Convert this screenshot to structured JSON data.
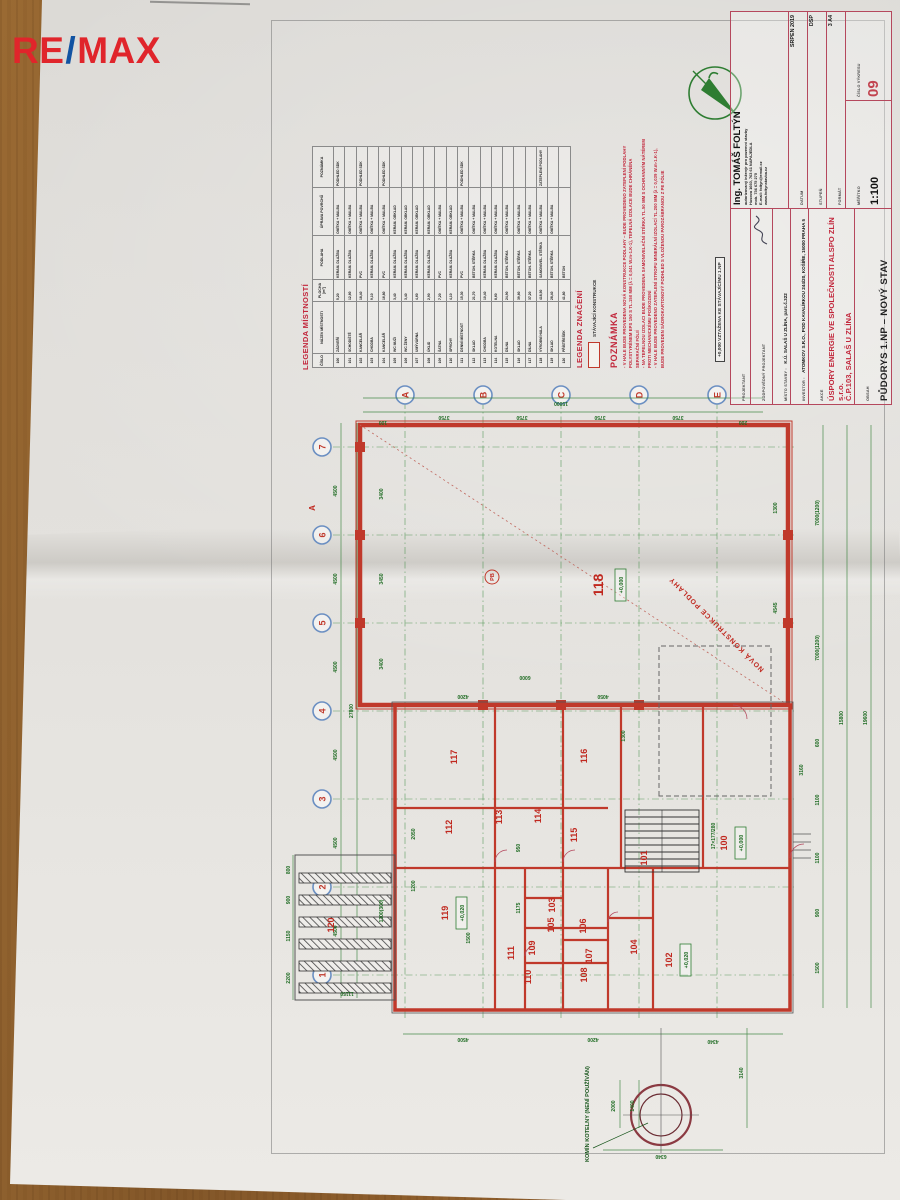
{
  "watermark": {
    "text": "RE/MAX",
    "re": "RE",
    "slash": "/",
    "max": "MAX",
    "red": "#e0252b",
    "blue": "#1253a2"
  },
  "legend": {
    "title": "LEGENDA MÍSTNOSTÍ",
    "headers": [
      "ČÍSLO",
      "NÁZEV MÍSTNOSTI",
      "PLOCHA [m²]",
      "PODLAHA",
      "ÚPRAVA POVRCHŮ",
      "POZNÁMKA"
    ],
    "rows": [
      [
        "100",
        "ZÁDVEŘÍ",
        "5,20",
        "KERAM. DLAŽBA",
        "OMÍTKA + MALBA",
        "PODHLED SDK"
      ],
      [
        "101",
        "SCHODIŠTĚ",
        "12,60",
        "KERAM. DLAŽBA",
        "OMÍTKA + MALBA",
        ""
      ],
      [
        "102",
        "KANCELÁŘ",
        "18,40",
        "PVC",
        "OMÍTKA + MALBA",
        "PODHLED SDK"
      ],
      [
        "103",
        "CHODBA",
        "9,10",
        "KERAM. DLAŽBA",
        "OMÍTKA + MALBA",
        ""
      ],
      [
        "104",
        "KANCELÁŘ",
        "16,80",
        "PVC",
        "OMÍTKA + MALBA",
        "PODHLED SDK"
      ],
      [
        "105",
        "WC MUŽI",
        "3,40",
        "KERAM. DLAŽBA",
        "KERAM. OBKLAD",
        ""
      ],
      [
        "106",
        "WC ŽENY",
        "3,40",
        "KERAM. DLAŽBA",
        "KERAM. OBKLAD",
        ""
      ],
      [
        "107",
        "UMÝVÁRNA",
        "4,60",
        "KERAM. DLAŽBA",
        "KERAM. OBKLAD",
        ""
      ],
      [
        "108",
        "ÚKLID",
        "2,90",
        "KERAM. DLAŽBA",
        "KERAM. OBKLAD",
        ""
      ],
      [
        "109",
        "ŠATNA",
        "7,20",
        "PVC",
        "OMÍTKA + MALBA",
        ""
      ],
      [
        "110",
        "SPRCHY",
        "4,10",
        "KERAM. DLAŽBA",
        "KERAM. OBKLAD",
        ""
      ],
      [
        "111",
        "DENNÍ MÍSTNOST",
        "15,30",
        "PVC",
        "OMÍTKA + MALBA",
        "PODHLED SDK"
      ],
      [
        "112",
        "SKLAD",
        "21,70",
        "BETON. STĚRKA",
        "OMÍTKA + MALBA",
        ""
      ],
      [
        "113",
        "CHODBA",
        "10,40",
        "KERAM. DLAŽBA",
        "OMÍTKA + MALBA",
        ""
      ],
      [
        "114",
        "KOTELNA",
        "8,60",
        "KERAM. DLAŽBA",
        "OMÍTKA + MALBA",
        ""
      ],
      [
        "115",
        "DÍLNA",
        "24,90",
        "BETON. STĚRKA",
        "OMÍTKA + MALBA",
        ""
      ],
      [
        "116",
        "SKLAD",
        "39,60",
        "BETON. STĚRKA",
        "OMÍTKA + MALBA",
        ""
      ],
      [
        "117",
        "DÍLNA",
        "37,20",
        "BETON. STĚRKA",
        "OMÍTKA + MALBA",
        ""
      ],
      [
        "118",
        "VÝROBNÍ HALA",
        "418,50",
        "SAMONIVEL. STĚRKA",
        "OMÍTKA + MALBA",
        "ZATEPLENÍ PODLAHY"
      ],
      [
        "119",
        "SKLAD",
        "28,40",
        "BETON. STĚRKA",
        "OMÍTKA + MALBA",
        ""
      ],
      [
        "120",
        "PŘÍSTŘEŠEK",
        "41,80",
        "BETON",
        "",
        ""
      ]
    ]
  },
  "marks": {
    "title": "LEGENDA ZNAČENÍ",
    "items": [
      {
        "label": "STÁVAJÍCÍ KONSTRUKCE"
      }
    ]
  },
  "note": {
    "title": "POZNÁMKA",
    "lines": [
      "V HALE BUDE PROVEDENA NOVÁ KONSTRUKCE PODLAHY – BUDE PROVEDENO ZATEPLENÍ PODLAHY POLYSTYRÉNEM EPS 150 S TL.150 MM (λ = 0,041 W.m-1.K-1), TEPELNÁ IZOLACE BUDE CHRÁNĚNA SEPARAČNÍ FÓLIÍ",
      "NA TEPELNOU IZOLACI BUDE PROVEDENA SAMONIVELAČNÍ STĚRKA TL.50 MM S OCHRANNÝM NÁTĚREM PROTI MECHANICKÉMU POŠKOZENÍ",
      "V HALE BUDE PROVEDENO ZATEPLENÍ STROPU MINERÁLNÍ IZOLACÍ TL.200 MM (λ = 0,039 W.m-1.K-1), BUDE PROVEDEN SÁDROKARTONOVÝ PODHLED S VLOŽENOU PAROZÁBRANOU Z PE FÓLIE"
    ]
  },
  "datum_note": "+0,000 VZTAŽENA KE STÁVAJÍCÍMU 1.NP",
  "title_block": {
    "projektant_label": "PROJEKTANT",
    "projektant": "MICHAELA VELCEROVÁ",
    "zodp_label": "ZODPOVĚDNÝ PROJEKTANT",
    "zodp": "ING. TOMÁŠ FOLTÝN",
    "misto_label": "MÍSTO STAVBY :",
    "misto": "K.Ú. SALAŠ U ZLÍNA, parc.č.322",
    "investor_label": "INVESTOR :",
    "investor": "ATOMKOV S.R.O., POD KAVALÍRKOU 244/20, KOŠÍŘE, 15000 PRAHA 5",
    "akce_label": "AKCE",
    "akce1": "ÚSPORY ENERGIE VE SPOLEČNOSTI ALSPO ZLÍN s.r.o.",
    "akce2": "Č.P.103, SALAŠ U ZLÍNA",
    "akce3": "D.1.1 ARCHITEKTONICKO-STAVEBNÍ ŘEŠENÍ",
    "obsah_label": "OBSAH",
    "obsah": "PŮDORYS 1.NP – NOVÝ STAV",
    "eng_name": "Ing. TOMÁŠ FOLTÝN",
    "eng_sub1": "autorizovaný inženýr pro pozemní stavby",
    "eng_sub2": "Husova 1660, 763 61 NAPAJEDLA",
    "eng_sub3": "mob. 736 675 275",
    "eng_sub4": "E-mail: foltyn@email.cz",
    "eng_sub5": "www.foltynstavba.cz",
    "datum_label": "DATUM",
    "datum": "SRPEN 2019",
    "stupen_label": "STUPEŇ",
    "stupen": "DSP",
    "format_label": "FORMÁT",
    "format": "3 A4",
    "meritko_label": "MĚŘÍTKO",
    "meritko": "1:100",
    "cislo_label": "ČÍSLO VÝKRESU",
    "cislo": "09"
  },
  "plan": {
    "grid_cols": [
      {
        "n": "1",
        "x": 193
      },
      {
        "n": "2",
        "x": 281
      },
      {
        "n": "3",
        "x": 369
      },
      {
        "n": "4",
        "x": 457
      },
      {
        "n": "5",
        "x": 545
      },
      {
        "n": "6",
        "x": 633
      },
      {
        "n": "7",
        "x": 721
      }
    ],
    "grid_rows": [
      {
        "n": "A",
        "y": 142
      },
      {
        "n": "B",
        "y": 220
      },
      {
        "n": "C",
        "y": 298
      },
      {
        "n": "D",
        "y": 376
      },
      {
        "n": "E",
        "y": 454
      }
    ],
    "rooms": [
      {
        "t": "118",
        "x": 583,
        "y": 340,
        "big": true
      },
      {
        "t": "117",
        "x": 411,
        "y": 194
      },
      {
        "t": "116",
        "x": 412,
        "y": 324
      },
      {
        "t": "115",
        "x": 333,
        "y": 314
      },
      {
        "t": "114",
        "x": 352,
        "y": 278
      },
      {
        "t": "113",
        "x": 351,
        "y": 239
      },
      {
        "t": "112",
        "x": 341,
        "y": 189
      },
      {
        "t": "111",
        "x": 215,
        "y": 251
      },
      {
        "t": "110",
        "x": 191,
        "y": 268
      },
      {
        "t": "109",
        "x": 220,
        "y": 272
      },
      {
        "t": "108",
        "x": 193,
        "y": 324
      },
      {
        "t": "107",
        "x": 212,
        "y": 329
      },
      {
        "t": "106",
        "x": 242,
        "y": 323
      },
      {
        "t": "105",
        "x": 243,
        "y": 291
      },
      {
        "t": "103",
        "x": 263,
        "y": 292
      },
      {
        "t": "104",
        "x": 221,
        "y": 374
      },
      {
        "t": "102",
        "x": 208,
        "y": 409
      },
      {
        "t": "101",
        "x": 310,
        "y": 384
      },
      {
        "t": "100",
        "x": 325,
        "y": 464
      },
      {
        "t": "119",
        "x": 255,
        "y": 185
      },
      {
        "t": "120",
        "x": 243,
        "y": 71
      }
    ],
    "elevations": [
      {
        "t": "+0,000",
        "x": 583,
        "y": 360
      },
      {
        "t": "+0,020",
        "x": 255,
        "y": 201
      },
      {
        "t": "+0,020",
        "x": 208,
        "y": 425
      },
      {
        "t": "+0,000",
        "x": 325,
        "y": 480
      }
    ],
    "dims": [
      {
        "t": "4500",
        "x": 237,
        "y": 74
      },
      {
        "t": "4500",
        "x": 325,
        "y": 74
      },
      {
        "t": "4500",
        "x": 413,
        "y": 74
      },
      {
        "t": "4500",
        "x": 501,
        "y": 74
      },
      {
        "t": "4500",
        "x": 589,
        "y": 74
      },
      {
        "t": "4500",
        "x": 677,
        "y": 74
      },
      {
        "t": "27800",
        "x": 457,
        "y": 90
      },
      {
        "t": "3750",
        "x": 752,
        "y": 181,
        "r": -90
      },
      {
        "t": "3750",
        "x": 752,
        "y": 259,
        "r": -90
      },
      {
        "t": "3750",
        "x": 752,
        "y": 337,
        "r": -90
      },
      {
        "t": "3750",
        "x": 752,
        "y": 415,
        "r": -90
      },
      {
        "t": "15000",
        "x": 766,
        "y": 298,
        "r": -90
      },
      {
        "t": "100",
        "x": 747,
        "y": 120,
        "r": -90
      },
      {
        "t": "200",
        "x": 747,
        "y": 480,
        "r": -90
      },
      {
        "t": "3400",
        "x": 504,
        "y": 120
      },
      {
        "t": "3450",
        "x": 589,
        "y": 120
      },
      {
        "t": "3400",
        "x": 674,
        "y": 120
      },
      {
        "t": "4200",
        "x": 473,
        "y": 200,
        "r": -90
      },
      {
        "t": "4050",
        "x": 473,
        "y": 340,
        "r": -90
      },
      {
        "t": "6000",
        "x": 492,
        "y": 262,
        "r": -90
      },
      {
        "t": "4545",
        "x": 560,
        "y": 514
      },
      {
        "t": "1300",
        "x": 660,
        "y": 514
      },
      {
        "t": "2200",
        "x": 190,
        "y": 27
      },
      {
        "t": "1150",
        "x": 232,
        "y": 27
      },
      {
        "t": "900",
        "x": 268,
        "y": 27
      },
      {
        "t": "800",
        "x": 298,
        "y": 27
      },
      {
        "t": "11150",
        "x": 176,
        "y": 84,
        "r": -90
      },
      {
        "t": "1300(300)",
        "x": 257,
        "y": 120
      },
      {
        "t": "4500",
        "x": 130,
        "y": 200,
        "r": -90
      },
      {
        "t": "4200",
        "x": 130,
        "y": 330,
        "r": -90
      },
      {
        "t": "4340",
        "x": 128,
        "y": 450,
        "r": -90
      },
      {
        "t": "1200",
        "x": 282,
        "y": 152
      },
      {
        "t": "2050",
        "x": 334,
        "y": 152
      },
      {
        "t": "1500",
        "x": 230,
        "y": 207
      },
      {
        "t": "950",
        "x": 320,
        "y": 257
      },
      {
        "t": "1175",
        "x": 260,
        "y": 257
      },
      {
        "t": "1300",
        "x": 432,
        "y": 362
      },
      {
        "t": "1500",
        "x": 200,
        "y": 556
      },
      {
        "t": "900",
        "x": 255,
        "y": 556
      },
      {
        "t": "1100",
        "x": 310,
        "y": 556
      },
      {
        "t": "1100",
        "x": 368,
        "y": 556
      },
      {
        "t": "600",
        "x": 425,
        "y": 556
      },
      {
        "t": "7000(1200)",
        "x": 520,
        "y": 556
      },
      {
        "t": "7000(1200)",
        "x": 655,
        "y": 556
      },
      {
        "t": "15800",
        "x": 450,
        "y": 580
      },
      {
        "t": "19600",
        "x": 450,
        "y": 604
      },
      {
        "t": "3140",
        "x": 95,
        "y": 480
      },
      {
        "t": "2000",
        "x": 62,
        "y": 352
      },
      {
        "t": "1400",
        "x": 62,
        "y": 371
      },
      {
        "t": "6340",
        "x": 13,
        "y": 398,
        "r": -90
      },
      {
        "t": "17×177/280",
        "x": 332,
        "y": 452
      },
      {
        "t": "3160",
        "x": 398,
        "y": 540
      }
    ],
    "texts": [
      {
        "t": "NOVÁ KONSTRUKCE PODLAHY",
        "x": 545,
        "y": 455,
        "r": -45,
        "cls": "red7"
      },
      {
        "t": "KOMÍN KOTELNY (NENÍ POUŽÍVÁN)",
        "x": 6,
        "y": 326,
        "cls": "grn6"
      },
      {
        "t": "PB",
        "x": 591,
        "y": 231,
        "cls": "pbt"
      },
      {
        "t": "A",
        "x": 660,
        "y": 52,
        "cls": "sect"
      }
    ]
  }
}
